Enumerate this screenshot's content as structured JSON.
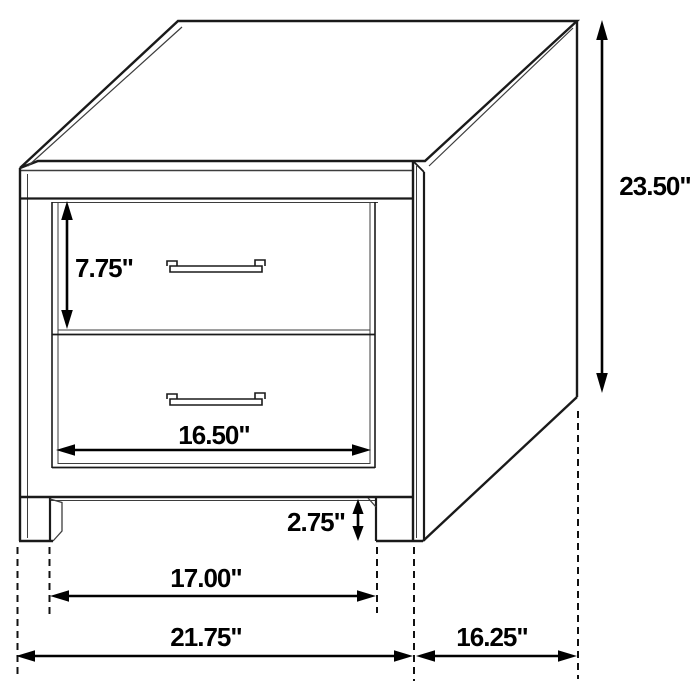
{
  "diagram": {
    "title": "two-drawer-nightstand-dimension-drawing",
    "background_color": "#ffffff",
    "line_color": "#1a1a1a",
    "text_color": "#000000",
    "dimensions": {
      "overall_height": "23.50\"",
      "drawer_height": "7.75\"",
      "drawer_width": "16.50\"",
      "base_clearance": "2.75\"",
      "leg_span_width": "17.00\"",
      "overall_width": "21.75\"",
      "overall_depth": "16.25\""
    }
  }
}
